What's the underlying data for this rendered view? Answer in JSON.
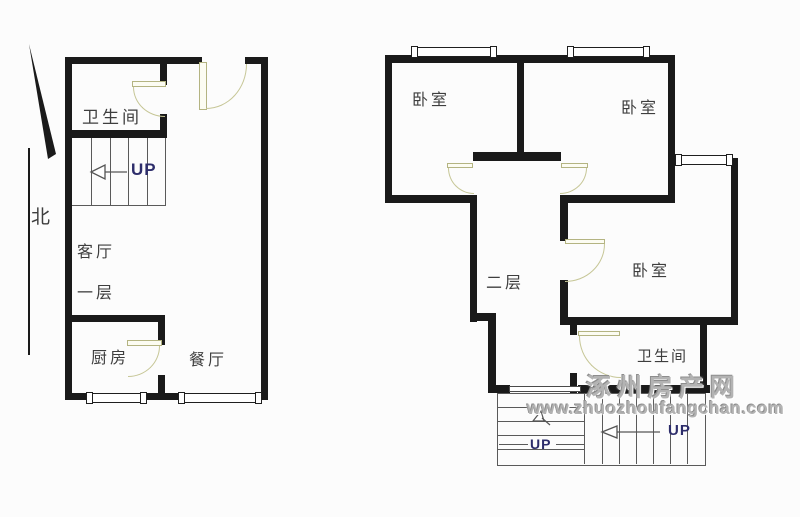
{
  "document": {
    "type": "floor-plan",
    "site_watermark": {
      "site_name": "涿州房产网",
      "site_url": "www.zhuozhoufangchan.com"
    },
    "north_label": "北",
    "colors": {
      "wall": "#1a1a1a",
      "thin_line": "#5a5a5a",
      "door_arc": "#c6c696",
      "up_text": "#2d2d6b",
      "room_label": "#3e3e3e",
      "watermark": "#b3b3b3",
      "background": "#fcfcfc"
    },
    "floor1": {
      "floor_label": "一层",
      "bathroom": "卫生间",
      "living_room": "客厅",
      "kitchen": "厨房",
      "dining_room": "餐厅",
      "stairs_up": "UP"
    },
    "floor2": {
      "floor_label": "二层",
      "bedroom_top_left": "卧室",
      "bedroom_top_right": "卧室",
      "bedroom_right": "卧室",
      "bathroom": "卫生间",
      "stairs_up_left": "UP",
      "stairs_up_right": "UP"
    }
  }
}
